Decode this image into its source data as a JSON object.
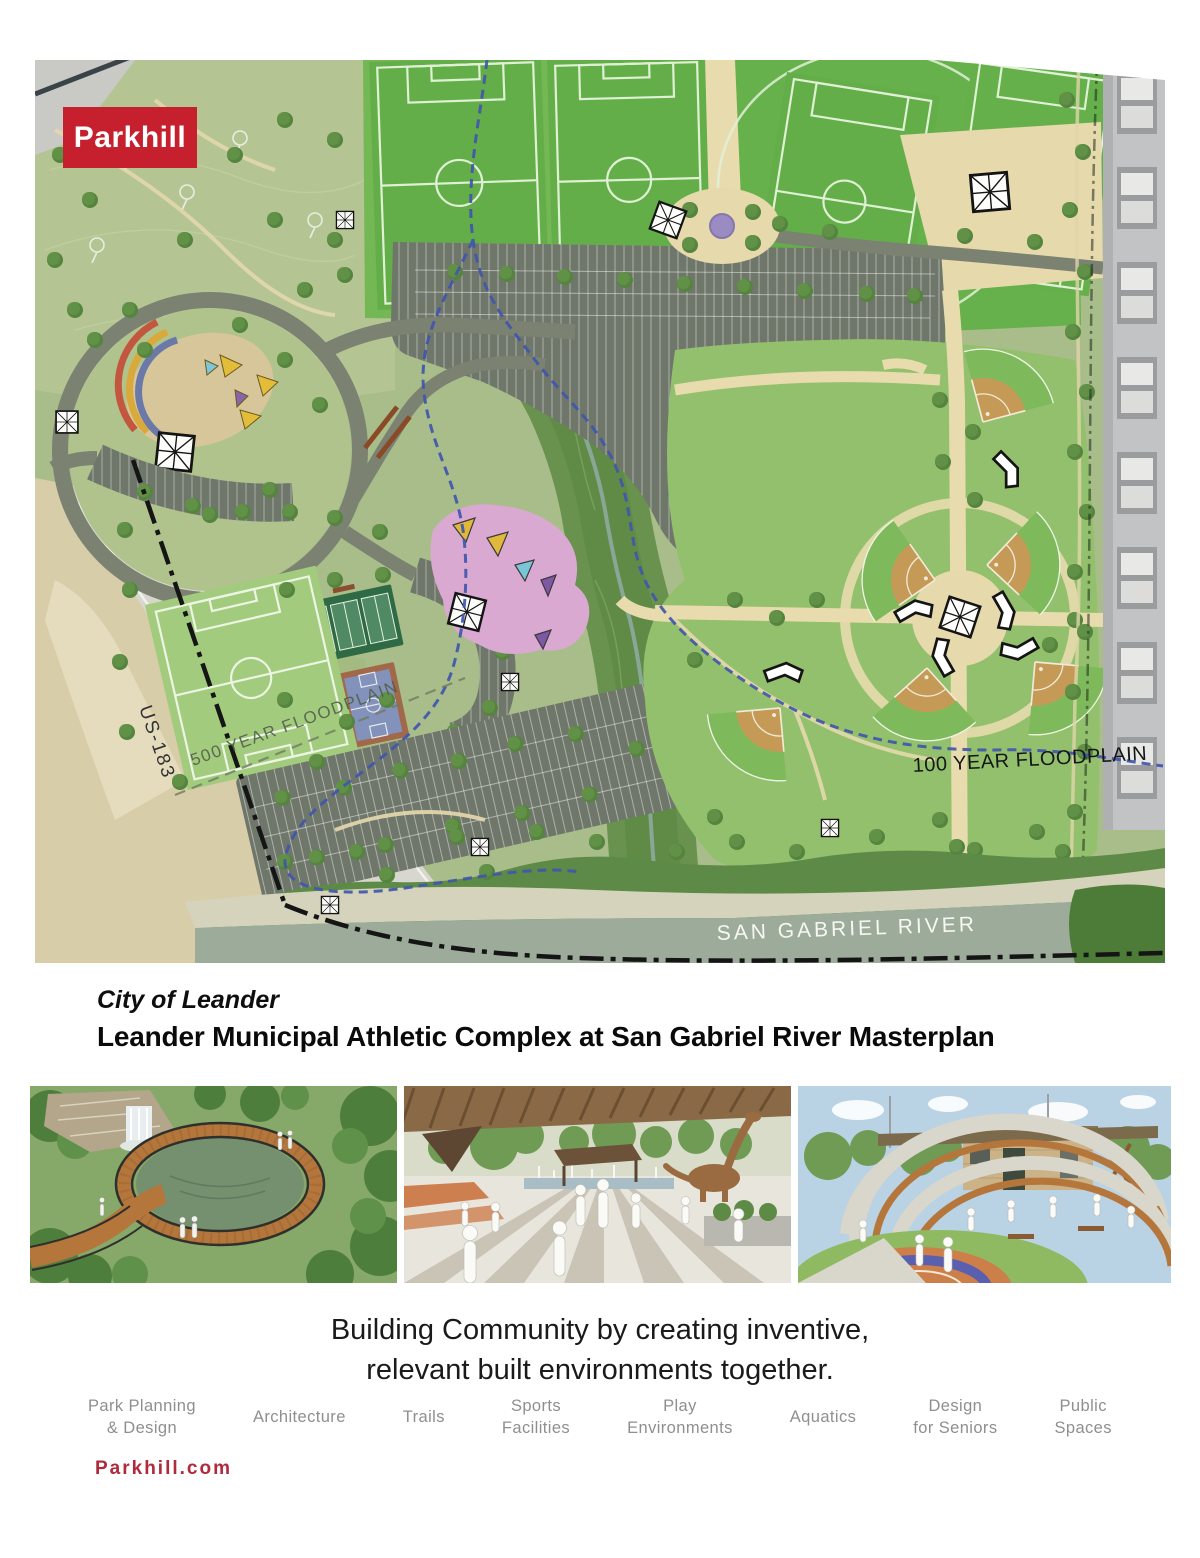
{
  "brand": {
    "logo_text": "Parkhill",
    "logo_bg": "#c6202f",
    "website": "Parkhill.com",
    "website_color": "#b02a3c"
  },
  "map": {
    "labels": {
      "highway": "US-183",
      "floodplain_500": "500 YEAR FLOODPLAIN",
      "floodplain_100": "100 YEAR FLOODPLAIN",
      "river": "SAN GABRIEL RIVER"
    }
  },
  "title": {
    "client": "City of Leander",
    "project": "Leander Municipal Athletic Complex at San Gabriel River Masterplan"
  },
  "renderings": [
    {
      "alt": "Circular boardwalk overlook ringing a waterfall pool in the woods"
    },
    {
      "alt": "Shaded plaza with striped paving, splash pad and dinosaur play sculpture"
    },
    {
      "alt": "Miniature ballfield wrapped by terraced amphitheater seating and stone pavilion"
    }
  ],
  "tagline": {
    "line1": "Building Community by creating inventive,",
    "line2": "relevant built environments together."
  },
  "services": [
    {
      "label": "Park Planning\n& Design"
    },
    {
      "label": "Architecture"
    },
    {
      "label": "Trails"
    },
    {
      "label": "Sports\nFacilities"
    },
    {
      "label": "Play\nEnvironments"
    },
    {
      "label": "Aquatics"
    },
    {
      "label": "Design\nfor Seniors"
    },
    {
      "label": "Public\nSpaces"
    }
  ]
}
